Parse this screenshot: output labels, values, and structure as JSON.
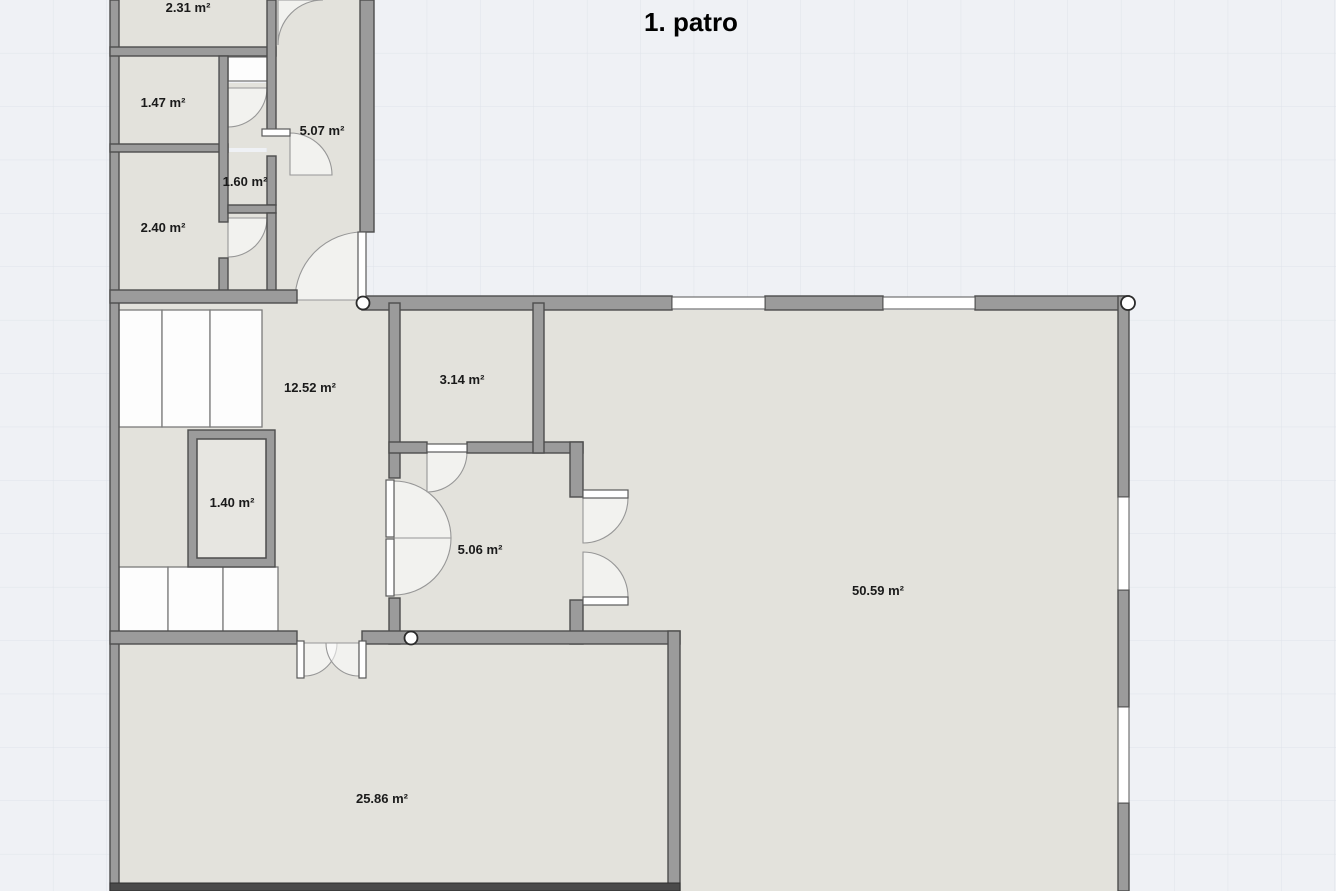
{
  "title": "1. patro",
  "floor_plan": {
    "floor_label": "1. patro",
    "rooms": [
      {
        "name": "room-top-1",
        "area_label": "2.31 m²"
      },
      {
        "name": "room-top-2",
        "area_label": "1.47 m²"
      },
      {
        "name": "corridor",
        "area_label": "5.07 m²"
      },
      {
        "name": "room-top-3",
        "area_label": "1.60 m²"
      },
      {
        "name": "room-top-4",
        "area_label": "2.40 m²"
      },
      {
        "name": "hall",
        "area_label": "12.52 m²"
      },
      {
        "name": "small-room",
        "area_label": "3.14 m²"
      },
      {
        "name": "shaft",
        "area_label": "1.40 m²"
      },
      {
        "name": "vestibule",
        "area_label": "5.06 m²"
      },
      {
        "name": "large-room",
        "area_label": "50.59 m²"
      },
      {
        "name": "bottom-room",
        "area_label": "25.86 m²"
      }
    ]
  },
  "colors": {
    "canvas_background": "#eff1f5",
    "grid_line": "#dfe3ea",
    "room_fill": "#e3e2dc",
    "wall_fill": "#9b9b9b",
    "wall_outline": "#4d4d4d",
    "door_window_fill": "#ffffff",
    "label_text": "#1a1a1a",
    "title_text": "#000000"
  }
}
